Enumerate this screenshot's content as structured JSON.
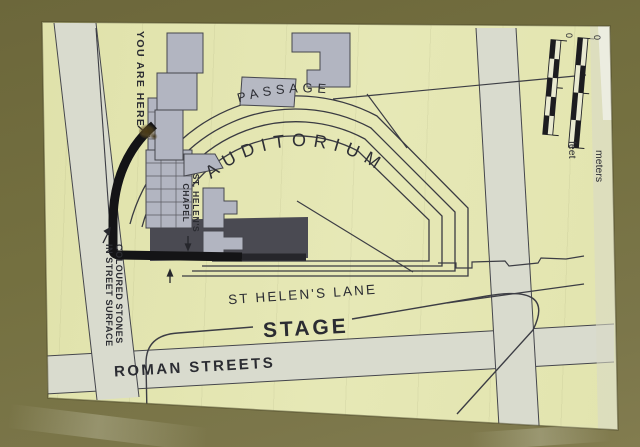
{
  "sign": {
    "labels": {
      "you_are_here": "YOU ARE HERE",
      "passage": "PASSAGE",
      "auditorium": "AUDITORIUM",
      "chapel_line1": "ST. HELEN'S",
      "chapel_line2": "CHAPEL",
      "coloured_stones_line1": "COLOURED STONES",
      "coloured_stones_line2": "IN STREET SURFACE",
      "st_helens_lane": "ST HELEN'S LANE",
      "stage": "STAGE",
      "roman_streets": "ROMAN STREETS"
    },
    "scale": {
      "feet_zero": "0",
      "meters_zero": "0",
      "feet_label": "feet",
      "meters_label": "meters"
    },
    "colors": {
      "board_olive": "#746f3e",
      "paper_yellow": "#e4e6b2",
      "street_light": "#d9dbce",
      "building_grey": "#b2b5c1",
      "precinct_dark": "#4a4a52",
      "wall_black": "#141416",
      "ink": "#2e2f35"
    }
  }
}
